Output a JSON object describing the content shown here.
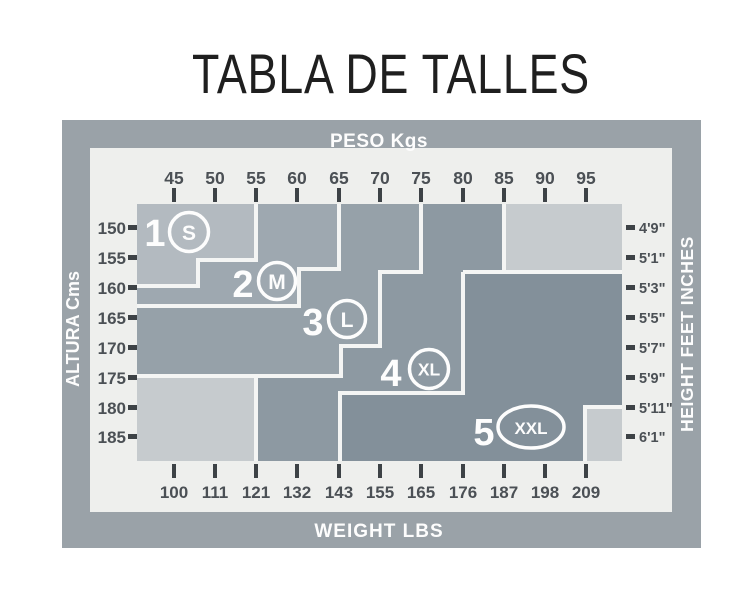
{
  "title": "TABLA DE TALLES",
  "frame": {
    "top_axis": {
      "label": "PESO Kgs",
      "ticks": [
        "45",
        "50",
        "55",
        "60",
        "65",
        "70",
        "75",
        "80",
        "85",
        "90",
        "95"
      ]
    },
    "bottom_axis": {
      "label": "WEIGHT LBS",
      "ticks": [
        "100",
        "111",
        "121",
        "132",
        "143",
        "155",
        "165",
        "176",
        "187",
        "198",
        "209"
      ]
    },
    "left_axis": {
      "label": "ALTURA Cms",
      "ticks": [
        "150",
        "155",
        "160",
        "165",
        "170",
        "175",
        "180",
        "185"
      ]
    },
    "right_axis": {
      "label": "HEIGHT FEET INCHES",
      "ticks": [
        "4'9\"",
        "5'1\"",
        "5'3\"",
        "5'5\"",
        "5'7\"",
        "5'9\"",
        "5'11\"",
        "6'1\""
      ]
    }
  },
  "sizes": [
    {
      "number": "1",
      "code": "S"
    },
    {
      "number": "2",
      "code": "M"
    },
    {
      "number": "3",
      "code": "L"
    },
    {
      "number": "4",
      "code": "XL"
    },
    {
      "number": "5",
      "code": "XXL"
    }
  ],
  "colors": {
    "frame_band": "#9aa2a8",
    "panel": "#eeefed",
    "size_s": "#b3bac0",
    "size_m": "#9ea8b0",
    "size_l": "#96a1a9",
    "size_xl": "#8d99a2",
    "size_xxl": "#83909a",
    "unsized": "#c6cbce",
    "boundary": "#f4f5f4",
    "tick": "#3d4246",
    "axis_text": "#4b5055",
    "band_text": "#fdfdfd",
    "label_white": "#fdfdfd",
    "title_text": "#1f1f1f"
  },
  "chart_data": {
    "type": "area",
    "title": "TABLA DE TALLES",
    "description": "Stepped size-region chart mapping body weight and height to garment sizes 1-5 (S-XXL).",
    "x_axis": {
      "top_label": "PESO Kgs",
      "bottom_label": "WEIGHT LBS",
      "kg_ticks": [
        45,
        50,
        55,
        60,
        65,
        70,
        75,
        80,
        85,
        90,
        95
      ],
      "lbs_ticks": [
        100,
        111,
        121,
        132,
        143,
        155,
        165,
        176,
        187,
        198,
        209
      ],
      "range_kg": [
        41,
        99
      ]
    },
    "y_axis": {
      "left_label": "ALTURA Cms",
      "right_label": "HEIGHT FEET INCHES",
      "cm_ticks": [
        150,
        155,
        160,
        165,
        170,
        175,
        180,
        185
      ],
      "feet_inches_ticks": [
        "4'9\"",
        "5'1\"",
        "5'3\"",
        "5'5\"",
        "5'7\"",
        "5'9\"",
        "5'11\"",
        "6'1\""
      ],
      "range_cm": [
        146,
        189
      ]
    },
    "grid": false,
    "regions": [
      {
        "size": "S",
        "label": "1",
        "polygon_kg_cm": [
          [
            41,
            146
          ],
          [
            55,
            146
          ],
          [
            55,
            155
          ],
          [
            48,
            155
          ],
          [
            48,
            160
          ],
          [
            41,
            160
          ]
        ]
      },
      {
        "size": "M",
        "label": "2",
        "polygon_kg_cm": [
          [
            55,
            146
          ],
          [
            65,
            146
          ],
          [
            65,
            157
          ],
          [
            60,
            157
          ],
          [
            60,
            163
          ],
          [
            41,
            163
          ],
          [
            41,
            160
          ],
          [
            48,
            160
          ],
          [
            48,
            155
          ],
          [
            55,
            155
          ]
        ]
      },
      {
        "size": "L",
        "label": "3",
        "polygon_kg_cm": [
          [
            65,
            146
          ],
          [
            75,
            146
          ],
          [
            75,
            157
          ],
          [
            70,
            157
          ],
          [
            70,
            170
          ],
          [
            65,
            170
          ],
          [
            65,
            175
          ],
          [
            41,
            175
          ],
          [
            41,
            163
          ],
          [
            60,
            163
          ],
          [
            60,
            157
          ],
          [
            65,
            157
          ]
        ]
      },
      {
        "size": "XL",
        "label": "4",
        "polygon_kg_cm": [
          [
            75,
            146
          ],
          [
            85,
            146
          ],
          [
            85,
            157
          ],
          [
            80,
            157
          ],
          [
            80,
            177
          ],
          [
            65,
            177
          ],
          [
            65,
            189
          ],
          [
            55,
            189
          ],
          [
            55,
            175
          ],
          [
            65,
            175
          ],
          [
            65,
            170
          ],
          [
            70,
            170
          ],
          [
            70,
            157
          ],
          [
            75,
            157
          ]
        ]
      },
      {
        "size": "XXL",
        "label": "5",
        "polygon_kg_cm": [
          [
            80,
            157
          ],
          [
            99,
            157
          ],
          [
            99,
            180
          ],
          [
            95,
            180
          ],
          [
            95,
            189
          ],
          [
            65,
            189
          ],
          [
            65,
            177
          ],
          [
            80,
            177
          ]
        ]
      }
    ],
    "unsized_areas": [
      {
        "corner": "top-right",
        "polygon_kg_cm": [
          [
            85,
            146
          ],
          [
            99,
            146
          ],
          [
            99,
            157
          ],
          [
            85,
            157
          ]
        ]
      },
      {
        "corner": "bottom-left",
        "polygon_kg_cm": [
          [
            41,
            175
          ],
          [
            55,
            175
          ],
          [
            55,
            189
          ],
          [
            41,
            189
          ]
        ]
      },
      {
        "corner": "bottom-right",
        "polygon_kg_cm": [
          [
            95,
            180
          ],
          [
            99,
            180
          ],
          [
            99,
            189
          ],
          [
            95,
            189
          ]
        ]
      }
    ]
  }
}
